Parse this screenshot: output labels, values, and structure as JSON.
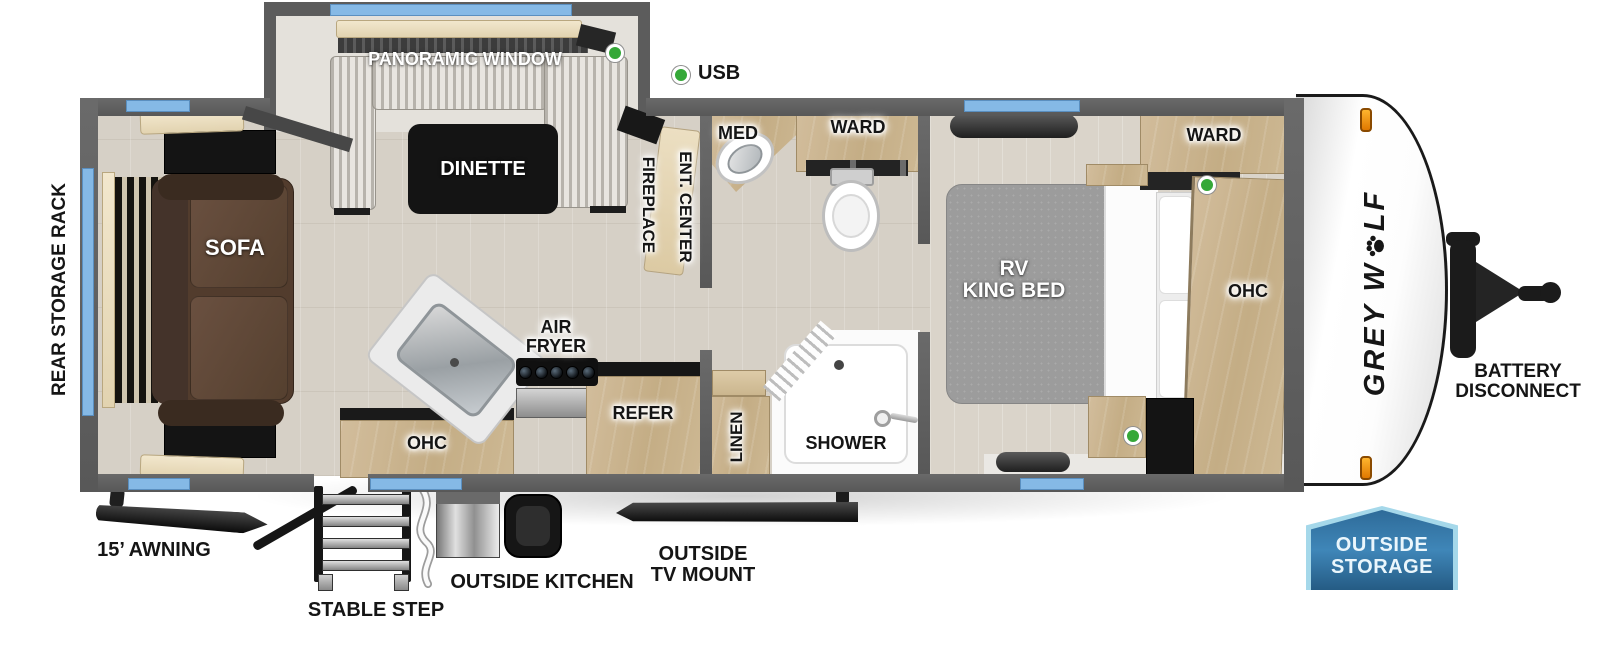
{
  "title": "Grey Wolf travel trailer floor plan",
  "brand": {
    "part1": "GREY W",
    "part2": "LF",
    "full": "GREY WOLF"
  },
  "legend": {
    "usb": "USB"
  },
  "slideout": {
    "panoramic_window": "PANORAMIC WINDOW",
    "dinette": "DINETTE"
  },
  "living": {
    "sofa": "SOFA",
    "rear_storage_rack": "REAR STORAGE RACK",
    "fireplace": "FIREPLACE",
    "ent_center": "ENT. CENTER"
  },
  "kitchen": {
    "air_fryer_line1": "AIR",
    "air_fryer_line2": "FRYER",
    "ohc": "OHC",
    "refer": "REFER"
  },
  "bathroom": {
    "med": "MED",
    "ward": "WARD",
    "linen": "LINEN",
    "shower": "SHOWER"
  },
  "bedroom": {
    "bed_line1": "RV",
    "bed_line2": "KING BED",
    "ward": "WARD",
    "ohc": "OHC"
  },
  "front": {
    "battery_line1": "BATTERY",
    "battery_line2": "DISCONNECT"
  },
  "exterior": {
    "awning": "15’ AWNING",
    "stable_step": "STABLE STEP",
    "outside_kitchen": "OUTSIDE KITCHEN",
    "tv_mount_line1": "OUTSIDE",
    "tv_mount_line2": "TV MOUNT",
    "storage_line1": "OUTSIDE",
    "storage_line2": "STORAGE"
  },
  "colors": {
    "wall": "#5c5c5c",
    "floor": "#d6d0c6",
    "wood": "#c9b593",
    "window_blue": "#85b9e6",
    "usb_green": "#35a838",
    "badge_blue_light": "#3f86b8",
    "badge_blue_dark": "#22577f",
    "badge_border": "#a5d8ea",
    "sofa_brown": "#523c2d",
    "fixture_black": "#141414"
  }
}
